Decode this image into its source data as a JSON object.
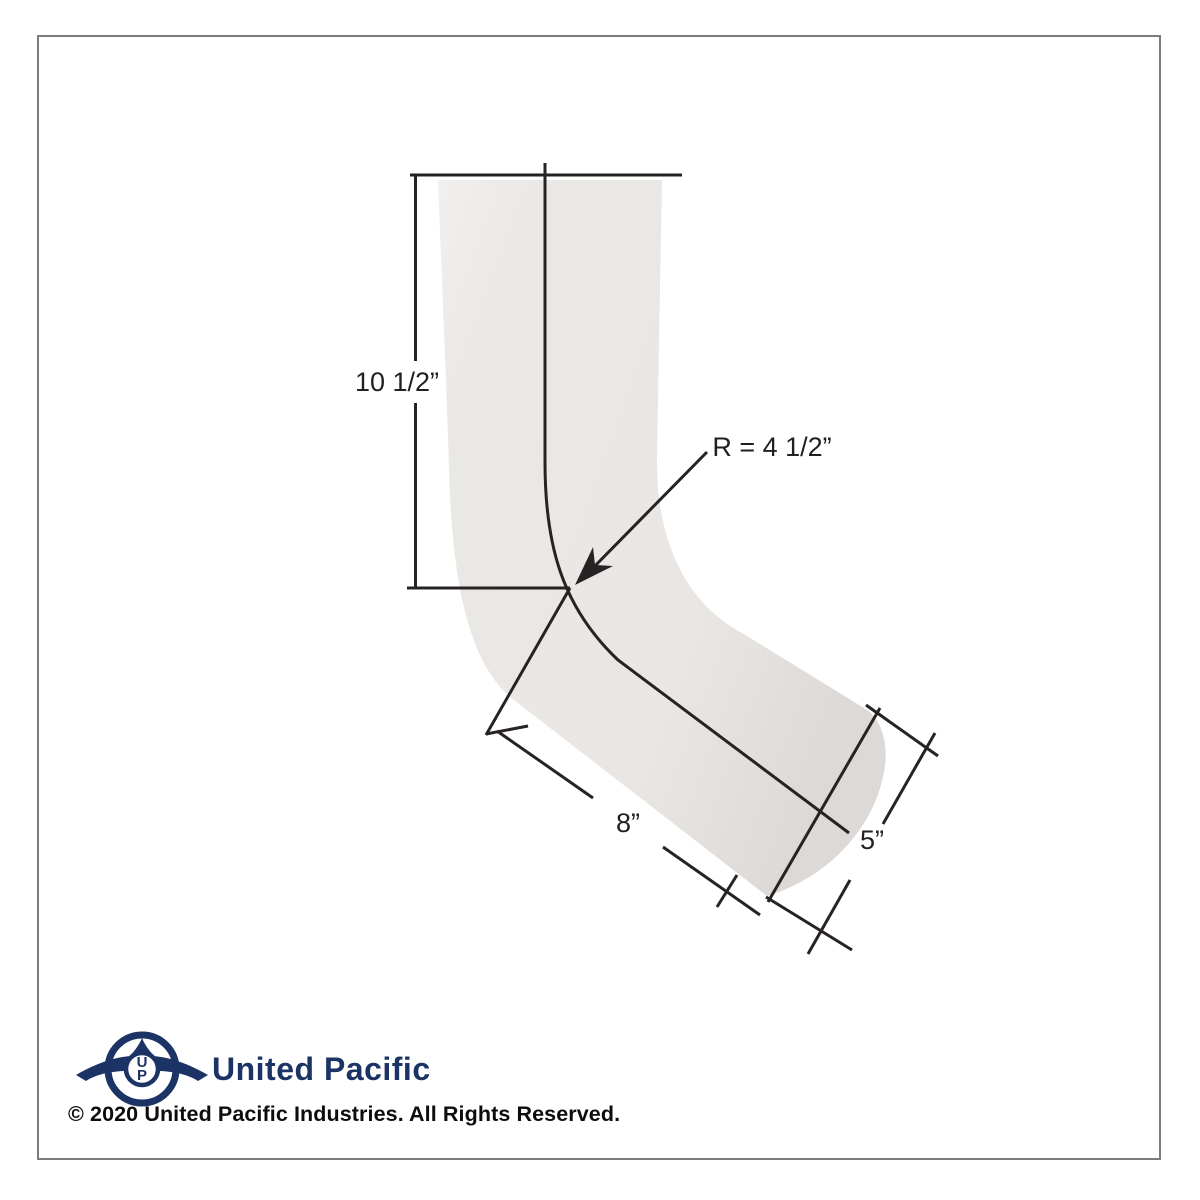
{
  "page": {
    "background": "#ffffff",
    "border_color": "#7c7c7c"
  },
  "diagram": {
    "kind": "technical-drawing",
    "subject": "bent-elbow-pipe",
    "pipe_fill": "#e9e6e3",
    "line_color": "#272223",
    "dimensions": {
      "vertical_leg": "10 1/2”",
      "bend_radius": "R = 4 1/2”",
      "lower_leg": "8”",
      "end_width": "5”"
    }
  },
  "footer": {
    "logo": {
      "monogram_top": "U",
      "monogram_bottom": "P",
      "color": "#1b3465"
    },
    "brand": "United Pacific",
    "copyright": "© 2020 United Pacific Industries. All Rights Reserved."
  }
}
